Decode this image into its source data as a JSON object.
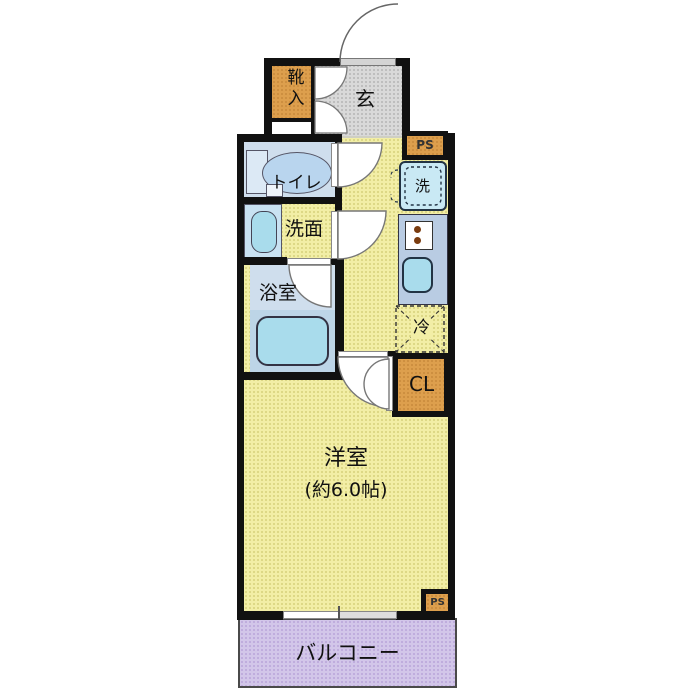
{
  "plan": {
    "type": "apartment-floor-plan",
    "rooms": {
      "entrance": {
        "label": "玄"
      },
      "shoe_cabinet": {
        "label": "靴入"
      },
      "toilet": {
        "label": "トイレ"
      },
      "washroom": {
        "label": "洗面"
      },
      "bathroom": {
        "label": "浴室"
      },
      "washer_space": {
        "label": "洗"
      },
      "fridge_space": {
        "label": "冷"
      },
      "closet": {
        "label": "CL"
      },
      "pipe_space_top": {
        "label": "PS"
      },
      "pipe_space_bottom": {
        "label": "PS"
      },
      "main_room": {
        "label": "洋室",
        "size": "(約6.0帖)"
      },
      "balcony": {
        "label": "バルコニー"
      }
    },
    "colors": {
      "wall": "#111111",
      "room_yellow": "#f2eea6",
      "entrance_gray": "#d9d9d9",
      "storage_orange": "#dd9f4d",
      "wet_room_blue": "#cfdeed",
      "bath_lower_blue": "#bdd5e7",
      "fixture_cyan": "#a9dcec",
      "kitchen_counter_blue": "#b9cce3",
      "washer_blue": "#c9e9f4",
      "balcony_lavender": "#d2c6e9"
    }
  }
}
